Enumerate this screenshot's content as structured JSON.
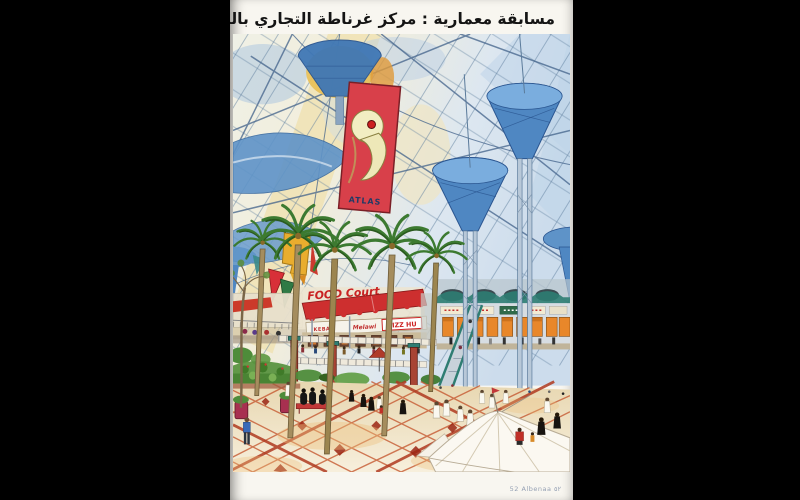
{
  "page": {
    "title": "مسابقة معمارية : مركز غرناطة التجاري بالرياض",
    "footer": "52 Albenaa ٥٢"
  },
  "artwork": {
    "banner_logo_text": "ATLAS",
    "food_court_sign": "FOOD Court",
    "shop_signs": [
      "KEBAB",
      "Melawi",
      "PIZZ HU"
    ],
    "palette": {
      "letterbox_black": "#000000",
      "paper_white": "#f8f6f0",
      "glass_blue": "#4f87c2",
      "banner_red": "#d8404a",
      "awning_red": "#cd2f2f",
      "palm_green": "#3c7a30",
      "floor_cream": "#f0e2bf",
      "tile_red": "#c65a32",
      "shop_window_orange": "#e8872a",
      "canopy_teal": "#2e7d72"
    }
  }
}
